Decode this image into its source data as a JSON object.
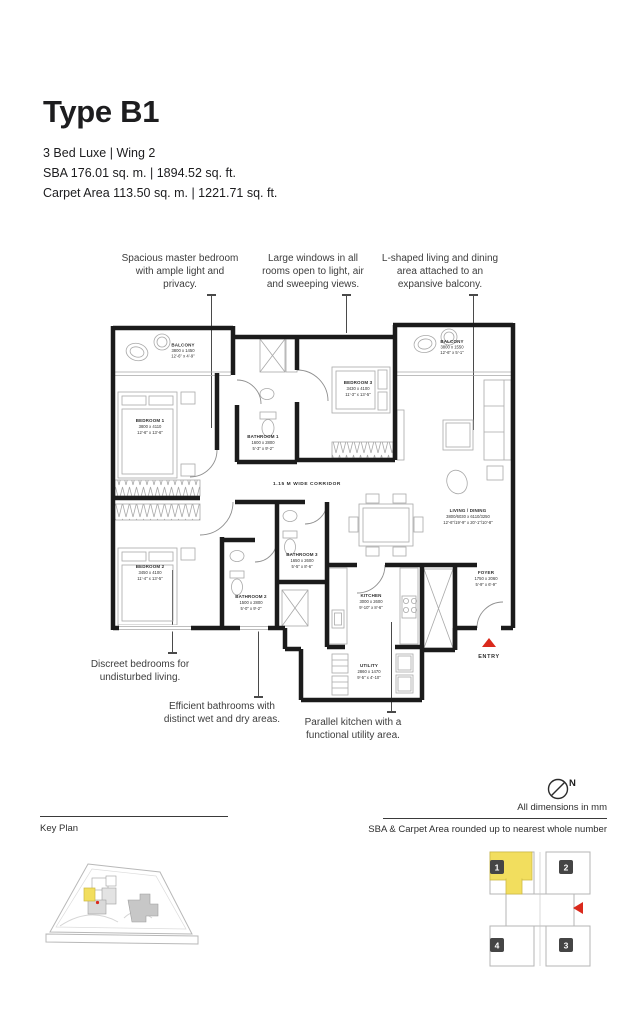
{
  "page": {
    "title": "Type B1",
    "subtitle": "3 Bed Luxe | Wing 2",
    "sba_line": "SBA 176.01 sq. m. | 1894.52 sq. ft.",
    "carpet_line": "Carpet Area 113.50 sq. m. | 1221.71 sq. ft."
  },
  "callouts": {
    "top": [
      "Spacious master bedroom with ample light and privacy.",
      "Large windows in all rooms open to light, air and sweeping views.",
      "L-shaped living and dining area attached to an expansive balcony."
    ],
    "bottom": [
      "Discreet bedrooms for undisturbed living.",
      "Efficient bathrooms with distinct wet and dry areas.",
      "Parallel kitchen with a functional utility area."
    ]
  },
  "plan": {
    "corridor_label": "1.15 M WIDE CORRIDOR",
    "entry_label": "ENTRY",
    "rooms": {
      "balcony1": {
        "name": "BALCONY",
        "mm": "3800 x 1450",
        "ft": "12'-6\" x 4'-9\""
      },
      "bedroom1": {
        "name": "BEDROOM 1",
        "mm": "3800 x 4110",
        "ft": "12'-6\" x 13'-6\""
      },
      "bathroom1": {
        "name": "BATHROOM 1",
        "mm": "1600 x 2800",
        "ft": "5'-3\" x 9'-2\""
      },
      "bedroom3": {
        "name": "BEDROOM 3",
        "mm": "3430 x 4100",
        "ft": "11'-3\" x 13'-5\""
      },
      "balcony2": {
        "name": "BALCONY",
        "mm": "3800 x 1550",
        "ft": "12'-6\" x 5'-1\""
      },
      "living": {
        "name": "LIVING / DINING",
        "mm": "3800/6030 x 6110/3250",
        "ft": "12'-6\"/19'-9\" x 20'-1\"/10'-8\""
      },
      "bedroom2": {
        "name": "BEDROOM 2",
        "mm": "3450 x 4100",
        "ft": "11'-4\" x 13'-5\""
      },
      "bathroom2": {
        "name": "BATHROOM 2",
        "mm": "1500 x 2800",
        "ft": "5'-0\" x 9'-2\""
      },
      "bathroom3": {
        "name": "BATHROOM 3",
        "mm": "1650 x 2600",
        "ft": "5'-5\" x 8'-6\""
      },
      "kitchen": {
        "name": "KITCHEN",
        "mm": "3000 x 2600",
        "ft": "9'-10\" x 8'-6\""
      },
      "utility": {
        "name": "UTILITY",
        "mm": "2860 x 1470",
        "ft": "9'-5\" x 4'-10\""
      },
      "foyer": {
        "name": "FOYER",
        "mm": "1750 x 2060",
        "ft": "5'-9\" x 6'-9\""
      }
    }
  },
  "footer": {
    "north_label": "N",
    "dimensions_note": "All dimensions in mm",
    "rounding_note": "SBA & Carpet Area rounded up to nearest whole number",
    "key_plan_label": "Key Plan",
    "key_units": [
      "1",
      "2",
      "3",
      "4"
    ]
  },
  "colors": {
    "accent_yellow": "#F2DE5E",
    "accent_red": "#DA291C",
    "wall": "#1B1B1B"
  }
}
